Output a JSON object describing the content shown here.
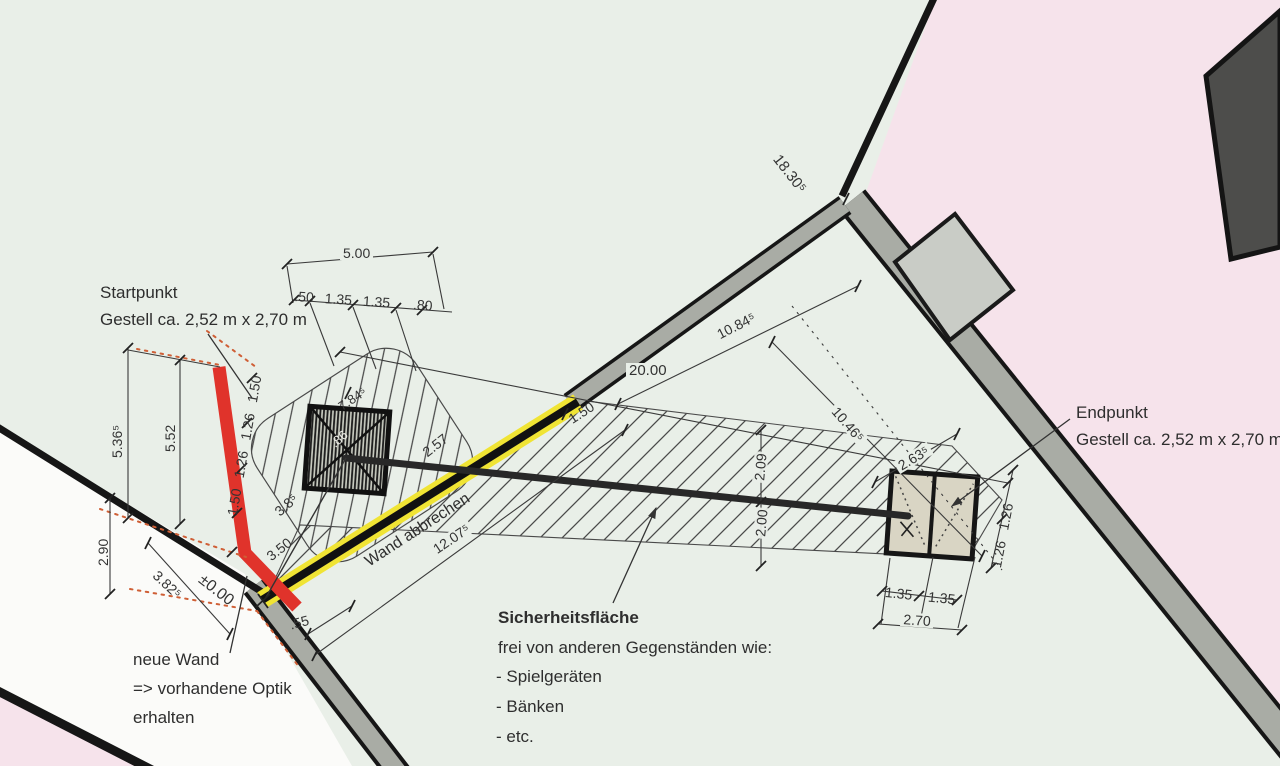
{
  "drawing": {
    "colors": {
      "site_green": "#e9efe8",
      "neighbor_pink": "#f6e3eb",
      "outside_white": "#fbfbf9",
      "wall_gray": "#a9aca5",
      "new_wall_red": "#e0332b",
      "demolition_yellow": "#f0e434",
      "frame_dark": "#1d1d1d",
      "end_frame_beige": "#d9d5c4"
    },
    "labels": {
      "startpunkt_title": "Startpunkt",
      "startpunkt_sub": "Gestell ca. 2,52 m x 2,70 m",
      "endpunkt_title": "Endpunkt",
      "endpunkt_sub": "Gestell ca. 2,52 m x 2,70 m",
      "sicherheit_title": "Sicherheitsfläche",
      "sicherheit_line1": "frei von anderen Gegenständen wie:",
      "sicherheit_item1": "- Spielgeräten",
      "sicherheit_item2": "- Bänken",
      "sicherheit_item3": "- etc.",
      "neue_wand_line1": "neue Wand",
      "neue_wand_line2": "=> vorhandene Optik",
      "neue_wand_line3": "erhalten",
      "wand_abbrechen": "Wand abbrechen",
      "level_marker": "±0.00"
    },
    "dimensions": {
      "top_width": "5.00",
      "top_chain": [
        ".50",
        "1.35",
        "1.35",
        ".80"
      ],
      "wall_total": "18.30⁵",
      "span_total": "20.00",
      "diag_upper": "10.84⁵",
      "diag_lower": "10.46⁵",
      "demolition_length": "12.07⁵",
      "left_outer": "5.36⁵",
      "left_inner": "5.52",
      "left_lower": "2.90",
      "bottom_diag": "3.82⁵",
      "new_wall_chain": [
        "1.50",
        "1.26",
        "1.26",
        "1.50"
      ],
      "start_diag": "7.84⁵",
      "start_inner": ".86",
      "start_gap": "2.57",
      "wall_remnant": "1.50",
      "band_upper_half": "2.09",
      "band_lower_half": "2.00",
      "end_diag": "2.63⁵",
      "end_chain_right": [
        "1.26",
        "1.26"
      ],
      "end_chain_bottom": [
        "1.35",
        "1.35"
      ],
      "end_width": "2.70",
      "wall_thickness": ".55",
      "gap_lower": "3.50",
      "lower_diag": "3.8⁵"
    }
  }
}
